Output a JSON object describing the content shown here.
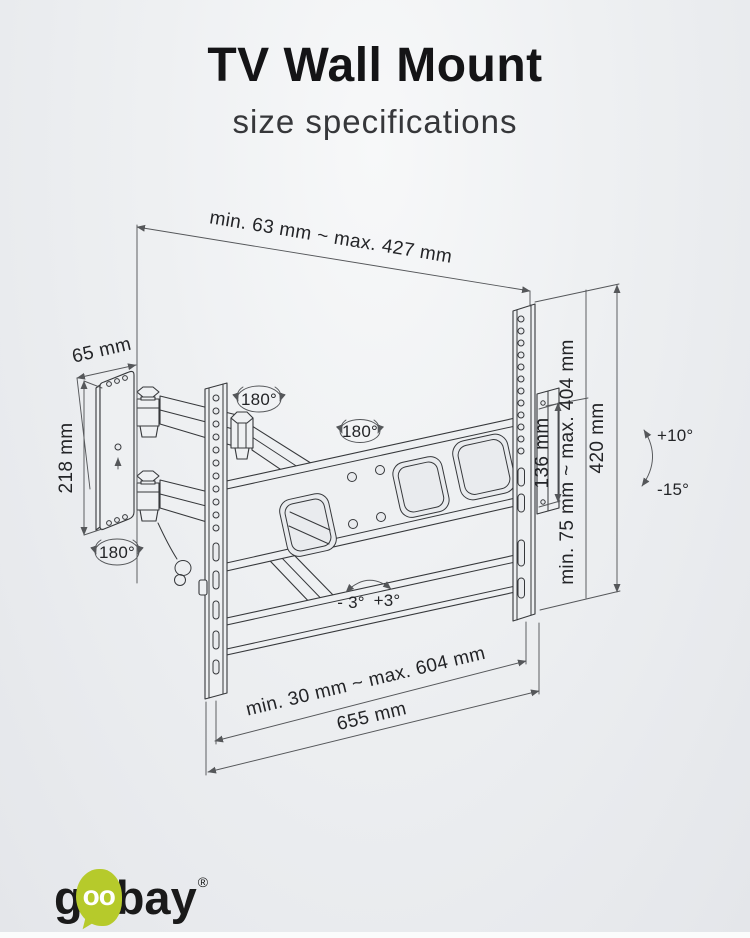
{
  "header": {
    "title": "TV Wall Mount",
    "subtitle": "size specifications"
  },
  "dimensions": {
    "extension_range": "min. 63 mm ~ max. 427 mm",
    "wall_plate_depth": "65 mm",
    "wall_plate_height": "218 mm",
    "rail_plate_height": "136 mm",
    "vesa_vertical_range": "min. 75 mm ~ max. 404 mm",
    "bracket_height": "420 mm",
    "vesa_horizontal_range": "min. 30 mm ~ max. 604 mm",
    "bracket_width": "655 mm"
  },
  "angles": {
    "swivel_plate": "180°",
    "swivel_arm": "180°",
    "swivel_bracket": "180°",
    "level_minus": "- 3°",
    "level_plus": "+3°",
    "tilt_up": "+10°",
    "tilt_down": "-15°"
  },
  "logo": {
    "g": "g",
    "oo": "oo",
    "bay": "bay",
    "registered": "®"
  },
  "colors": {
    "accent_green": "#b6ca2b",
    "line_dark": "#36383b",
    "dim_line": "#55575a"
  }
}
